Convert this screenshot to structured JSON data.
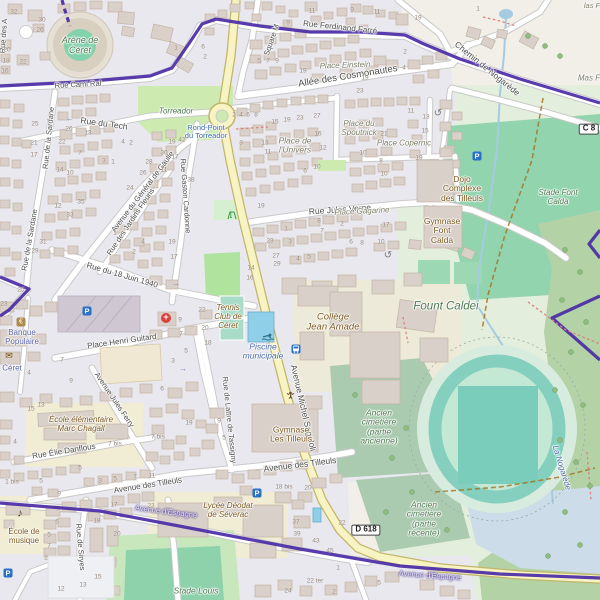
{
  "map": {
    "colors": {
      "route_purple": "#4a2ba6",
      "road_yellow": "#f7f3c3",
      "residential": "#e9e8ef",
      "pitch_green": "#8fd2ab",
      "park_green": "#cdebb0",
      "forest_green": "#b3d2a6",
      "cemetery_green": "#abcbb0",
      "water_blue": "#a5cbe0",
      "building": "#d9d0c9"
    },
    "road_refs": [
      {
        "t": "D 618",
        "x": 366,
        "y": 530
      },
      {
        "t": "C 8",
        "x": 589,
        "y": 129
      }
    ],
    "labels": [
      {
        "t": "Rue Cami Ral",
        "x": 78,
        "y": 85,
        "r": -3,
        "s": 7.5,
        "k": "st"
      },
      {
        "t": "Rue Ferdinand Farré",
        "x": 340,
        "y": 28,
        "r": 6,
        "s": 8,
        "k": "st"
      },
      {
        "t": "Allée des Cosmonautes",
        "x": 348,
        "y": 77,
        "r": -9,
        "s": 9.5,
        "k": "st"
      },
      {
        "t": "Chemin de Nogarède",
        "x": 487,
        "y": 69,
        "r": 39,
        "s": 8.5,
        "k": "st"
      },
      {
        "t": "Square M",
        "x": 272,
        "y": 40,
        "r": -71,
        "s": 7.5,
        "k": "st"
      },
      {
        "t": "Rue des A",
        "x": 4,
        "y": 36,
        "r": -86,
        "s": 7.5,
        "k": "st"
      },
      {
        "t": "Rue du Tech",
        "x": 104,
        "y": 124,
        "r": 8,
        "s": 8.5,
        "k": "st"
      },
      {
        "t": "Rue de la Sardane",
        "x": 49,
        "y": 138,
        "r": -84,
        "s": 7.5,
        "k": "st"
      },
      {
        "t": "Rue de la Sardane",
        "x": 30,
        "y": 240,
        "r": -80,
        "s": 7.5,
        "k": "st"
      },
      {
        "t": "Avenue du Général de Gaulle",
        "x": 143,
        "y": 192,
        "r": -53,
        "s": 7.5,
        "k": "st"
      },
      {
        "t": "Rue Gaston Cardonne",
        "x": 185,
        "y": 196,
        "r": 86,
        "s": 7.5,
        "k": "st"
      },
      {
        "t": "Rue des Jardins Fleuris",
        "x": 131,
        "y": 222,
        "r": -56,
        "s": 7.5,
        "k": "st"
      },
      {
        "t": "Rue du 18 Juin 1940",
        "x": 122,
        "y": 276,
        "r": 16,
        "s": 8,
        "k": "st"
      },
      {
        "t": "Rue Jules Verne",
        "x": 340,
        "y": 210,
        "r": -4,
        "s": 8.5,
        "k": "st"
      },
      {
        "t": "Avenue Michel Sageloli",
        "x": 303,
        "y": 408,
        "r": 77,
        "s": 8.5,
        "k": "st"
      },
      {
        "t": "Rue de Lattre de Tassigny",
        "x": 229,
        "y": 420,
        "r": 84,
        "s": 7.5,
        "k": "st"
      },
      {
        "t": "Avenue des Tilleuls",
        "x": 148,
        "y": 486,
        "r": -9,
        "s": 8,
        "k": "st"
      },
      {
        "t": "Avenue des Tilleuls",
        "x": 300,
        "y": 465,
        "r": -7,
        "s": 8.5,
        "k": "st"
      },
      {
        "t": "Rue Élie Danflous",
        "x": 64,
        "y": 452,
        "r": -9,
        "s": 8,
        "k": "st"
      },
      {
        "t": "Avenue Jules Ferry",
        "x": 114,
        "y": 400,
        "r": 56,
        "s": 7.5,
        "k": "st"
      },
      {
        "t": "Place Henri Guitard",
        "x": 122,
        "y": 342,
        "r": -8,
        "s": 8,
        "k": "st"
      },
      {
        "t": "Rue de Siryes",
        "x": 80,
        "y": 547,
        "r": 85,
        "s": 7.5,
        "k": "st"
      },
      {
        "t": "Avenue d'Espagne",
        "x": 166,
        "y": 512,
        "r": 7,
        "s": 7.5,
        "k": "stp"
      },
      {
        "t": "Avenue d'Espagne",
        "x": 430,
        "y": 576,
        "r": 4,
        "s": 7.5,
        "k": "stp"
      },
      {
        "t": "Place Einstein",
        "x": 345,
        "y": 66,
        "r": -2,
        "s": 8,
        "k": "pl"
      },
      {
        "t": "Place du\nSpoutnick",
        "x": 359,
        "y": 129,
        "r": 0,
        "s": 8,
        "k": "pl"
      },
      {
        "t": "Place Copernic",
        "x": 404,
        "y": 144,
        "r": 0,
        "s": 8,
        "k": "pl"
      },
      {
        "t": "Place de\nl'Univers",
        "x": 295,
        "y": 146,
        "r": 0,
        "s": 8.5,
        "k": "pl"
      },
      {
        "t": "Place Gagarine",
        "x": 362,
        "y": 212,
        "r": -3,
        "s": 8,
        "k": "pl"
      },
      {
        "t": "Mas F",
        "x": 589,
        "y": 79,
        "r": 0,
        "s": 8,
        "k": "pl"
      },
      {
        "t": "las F",
        "x": 592,
        "y": 6,
        "r": 0,
        "s": 7.5,
        "k": "pl"
      },
      {
        "t": "Rond-Point\ndu Torreador",
        "x": 206,
        "y": 132,
        "r": 0,
        "s": 7.5,
        "k": "blb"
      },
      {
        "t": "Torreador",
        "x": 176,
        "y": 112,
        "r": 0,
        "s": 8,
        "k": "grn"
      },
      {
        "t": "Arène de\nCéret",
        "x": 80,
        "y": 46,
        "r": 0,
        "s": 9,
        "k": "grn"
      },
      {
        "t": "Stade Font\nCalda",
        "x": 558,
        "y": 198,
        "r": 0,
        "s": 8,
        "k": "grn"
      },
      {
        "t": "Fount Caldei",
        "x": 446,
        "y": 307,
        "r": 0,
        "s": 11.5,
        "k": "grn"
      },
      {
        "t": "Ancien\ncimetière\n(partie\nancienne)",
        "x": 379,
        "y": 427,
        "r": 0,
        "s": 8.5,
        "k": "grn"
      },
      {
        "t": "Ancien\ncimetière\n(partie\nrécente)",
        "x": 424,
        "y": 519,
        "r": 0,
        "s": 8.5,
        "k": "grn"
      },
      {
        "t": "Stade Louis",
        "x": 196,
        "y": 591,
        "r": 0,
        "s": 8.5,
        "k": "grn"
      },
      {
        "t": "La Nogarède",
        "x": 561,
        "y": 468,
        "r": 73,
        "s": 8,
        "k": "blu"
      },
      {
        "t": "Piscine\nmunicipale",
        "x": 263,
        "y": 352,
        "r": 0,
        "s": 8.5,
        "k": "blu"
      },
      {
        "t": "Banque\nPopulaire",
        "x": 22,
        "y": 338,
        "r": 0,
        "s": 8,
        "k": "amn"
      },
      {
        "t": "Céret",
        "x": 12,
        "y": 369,
        "r": 0,
        "s": 8,
        "k": "amn"
      },
      {
        "t": "École de\nmusique",
        "x": 24,
        "y": 537,
        "r": 0,
        "s": 8,
        "k": "poi"
      },
      {
        "t": "École élémentaire\nMarc Chagall",
        "x": 81,
        "y": 425,
        "r": 0,
        "s": 8,
        "k": "poi-i"
      },
      {
        "t": "Lycée Déodat\nde Séverac",
        "x": 228,
        "y": 511,
        "r": 0,
        "s": 8,
        "k": "poi-i"
      },
      {
        "t": "Tennis\nClub de\nCéret",
        "x": 228,
        "y": 317,
        "r": 0,
        "s": 8,
        "k": "poi-i"
      },
      {
        "t": "Collège\nJean Amade",
        "x": 333,
        "y": 323,
        "r": 0,
        "s": 9.5,
        "k": "poi-i"
      },
      {
        "t": "Gymnase\nLes Tilleuls",
        "x": 291,
        "y": 435,
        "r": 0,
        "s": 8.5,
        "k": "poi"
      },
      {
        "t": "Dojo\nComplexe\ndes Tilleuls",
        "x": 462,
        "y": 189,
        "r": 0,
        "s": 8.5,
        "k": "poi"
      },
      {
        "t": "Gymnase\nFont\nCalda",
        "x": 442,
        "y": 231,
        "r": 0,
        "s": 8.5,
        "k": "poi"
      }
    ],
    "house_numbers": [
      [
        14,
        12,
        "32"
      ],
      [
        42,
        20,
        "30"
      ],
      [
        40,
        30,
        "26"
      ],
      [
        7,
        50,
        "20"
      ],
      [
        6,
        61,
        "18"
      ],
      [
        5,
        71,
        "16"
      ],
      [
        23,
        62,
        "22"
      ],
      [
        176,
        48,
        "1"
      ],
      [
        288,
        23,
        "9"
      ],
      [
        312,
        11,
        "11"
      ],
      [
        352,
        10,
        "9"
      ],
      [
        377,
        12,
        "11"
      ],
      [
        259,
        61,
        "5"
      ],
      [
        268,
        61,
        "7"
      ],
      [
        277,
        61,
        "9"
      ],
      [
        303,
        71,
        "19"
      ],
      [
        365,
        78,
        "19"
      ],
      [
        360,
        91,
        "23"
      ],
      [
        203,
        47,
        "6"
      ],
      [
        205,
        57,
        "2"
      ],
      [
        418,
        18,
        "19"
      ],
      [
        478,
        9,
        "1"
      ],
      [
        405,
        52,
        "2"
      ],
      [
        404,
        68,
        "4"
      ],
      [
        35,
        124,
        "25"
      ],
      [
        34,
        143,
        "21"
      ],
      [
        34,
        155,
        "17"
      ],
      [
        69,
        129,
        "26"
      ],
      [
        62,
        142,
        "22"
      ],
      [
        88,
        133,
        "13"
      ],
      [
        80,
        153,
        "7"
      ],
      [
        123,
        142,
        "4"
      ],
      [
        131,
        143,
        "2"
      ],
      [
        104,
        161,
        "3"
      ],
      [
        113,
        162,
        "1"
      ],
      [
        60,
        170,
        "14"
      ],
      [
        70,
        173,
        "10"
      ],
      [
        164,
        153,
        "30"
      ],
      [
        149,
        162,
        "28"
      ],
      [
        143,
        173,
        "26"
      ],
      [
        130,
        188,
        "24"
      ],
      [
        164,
        170,
        "11"
      ],
      [
        182,
        140,
        "42"
      ],
      [
        191,
        180,
        "38"
      ],
      [
        172,
        142,
        "19"
      ],
      [
        175,
        157,
        "17"
      ],
      [
        234,
        115,
        "2"
      ],
      [
        241,
        115,
        "4"
      ],
      [
        248,
        115,
        "6"
      ],
      [
        256,
        115,
        "8"
      ],
      [
        275,
        122,
        "15"
      ],
      [
        287,
        120,
        "19"
      ],
      [
        300,
        118,
        "23"
      ],
      [
        317,
        116,
        "27"
      ],
      [
        265,
        143,
        "13"
      ],
      [
        268,
        152,
        "11"
      ],
      [
        241,
        143,
        "3"
      ],
      [
        318,
        134,
        "16"
      ],
      [
        323,
        148,
        "12"
      ],
      [
        317,
        167,
        "10"
      ],
      [
        305,
        171,
        "6"
      ],
      [
        384,
        134,
        "21"
      ],
      [
        363,
        153,
        "10"
      ],
      [
        381,
        161,
        "8"
      ],
      [
        384,
        174,
        "10"
      ],
      [
        411,
        111,
        "11"
      ],
      [
        426,
        117,
        "13"
      ],
      [
        425,
        131,
        "15"
      ],
      [
        419,
        158,
        "19"
      ],
      [
        81,
        202,
        "35"
      ],
      [
        70,
        215,
        "33"
      ],
      [
        43,
        242,
        "31"
      ],
      [
        35,
        251,
        "29"
      ],
      [
        21,
        290,
        "25"
      ],
      [
        58,
        206,
        "12"
      ],
      [
        135,
        211,
        "8"
      ],
      [
        115,
        233,
        "1"
      ],
      [
        143,
        242,
        "4"
      ],
      [
        134,
        252,
        "2"
      ],
      [
        172,
        242,
        "19"
      ],
      [
        174,
        257,
        "17"
      ],
      [
        261,
        206,
        "19"
      ],
      [
        270,
        241,
        "23"
      ],
      [
        276,
        256,
        "27"
      ],
      [
        277,
        264,
        "29"
      ],
      [
        251,
        268,
        "14"
      ],
      [
        250,
        278,
        "16"
      ],
      [
        286,
        229,
        "1"
      ],
      [
        290,
        242,
        "3"
      ],
      [
        319,
        221,
        "8"
      ],
      [
        322,
        231,
        "7"
      ],
      [
        342,
        224,
        "2"
      ],
      [
        351,
        242,
        "6"
      ],
      [
        362,
        243,
        "8"
      ],
      [
        381,
        242,
        "10"
      ],
      [
        298,
        259,
        "4"
      ],
      [
        309,
        257,
        "5"
      ],
      [
        386,
        225,
        "17"
      ],
      [
        4,
        304,
        "23"
      ],
      [
        180,
        320,
        "9"
      ],
      [
        181,
        334,
        "7"
      ],
      [
        186,
        351,
        "5"
      ],
      [
        173,
        361,
        "3"
      ],
      [
        62,
        360,
        "7"
      ],
      [
        71,
        381,
        "9"
      ],
      [
        29,
        373,
        "4"
      ],
      [
        162,
        389,
        "6"
      ],
      [
        202,
        310,
        "22"
      ],
      [
        205,
        328,
        "20"
      ],
      [
        208,
        343,
        "18"
      ],
      [
        31,
        409,
        "15"
      ],
      [
        41,
        405,
        "13"
      ],
      [
        15,
        442,
        "4"
      ],
      [
        115,
        444,
        "7 bis"
      ],
      [
        158,
        437,
        "7 bis"
      ],
      [
        189,
        423,
        "19"
      ],
      [
        80,
        468,
        "5"
      ],
      [
        100,
        481,
        "3"
      ],
      [
        115,
        479,
        "5"
      ],
      [
        135,
        477,
        "7"
      ],
      [
        152,
        476,
        "11"
      ],
      [
        12,
        482,
        "1 bis"
      ],
      [
        59,
        494,
        "9"
      ],
      [
        41,
        481,
        "5"
      ],
      [
        219,
        421,
        "9"
      ],
      [
        224,
        438,
        "5"
      ],
      [
        284,
        487,
        "18 bis"
      ],
      [
        308,
        488,
        "20"
      ],
      [
        57,
        522,
        "6"
      ],
      [
        49,
        535,
        "5"
      ],
      [
        49,
        546,
        "7"
      ],
      [
        46,
        558,
        "2"
      ],
      [
        97,
        521,
        "18"
      ],
      [
        117,
        534,
        "20"
      ],
      [
        98,
        577,
        "15"
      ],
      [
        83,
        585,
        "13"
      ],
      [
        61,
        589,
        "12"
      ],
      [
        114,
        505,
        "17"
      ],
      [
        151,
        506,
        "23"
      ],
      [
        296,
        522,
        "37"
      ],
      [
        297,
        534,
        "39"
      ],
      [
        316,
        541,
        "43"
      ],
      [
        330,
        551,
        "45"
      ],
      [
        342,
        523,
        "22"
      ],
      [
        338,
        568,
        "1"
      ],
      [
        315,
        581,
        "22 ter"
      ],
      [
        288,
        591,
        "24"
      ],
      [
        334,
        592,
        "2"
      ],
      [
        379,
        583,
        "5"
      ]
    ],
    "icons": [
      {
        "n": "parking-icon",
        "x": 87,
        "y": 311
      },
      {
        "n": "parking-icon",
        "x": 477,
        "y": 156
      },
      {
        "n": "parking-icon",
        "x": 257,
        "y": 493
      },
      {
        "n": "parking-icon",
        "x": 8,
        "y": 573
      },
      {
        "n": "bus-stop-icon",
        "x": 296,
        "y": 349
      },
      {
        "n": "pharmacy-cross-icon",
        "x": 166,
        "y": 318
      },
      {
        "n": "bank-icon",
        "x": 21,
        "y": 322
      },
      {
        "n": "post-office-icon",
        "x": 9,
        "y": 356
      },
      {
        "n": "music-school-icon",
        "x": 20,
        "y": 514
      },
      {
        "n": "swimming-icon",
        "x": 262,
        "y": 333
      },
      {
        "n": "playground-icon",
        "x": 227,
        "y": 211
      },
      {
        "n": "water-well-icon",
        "x": 286,
        "y": 390
      },
      {
        "n": "mini-roundabout-icon",
        "x": 438,
        "y": 114
      },
      {
        "n": "mini-roundabout-icon",
        "x": 388,
        "y": 256
      },
      {
        "n": "oneway-arrow-left-icon",
        "x": 70,
        "y": 119
      },
      {
        "n": "oneway-arrow-right-icon",
        "x": 176,
        "y": 284
      },
      {
        "n": "oneway-arrow-right-icon",
        "x": 183,
        "y": 369
      }
    ]
  }
}
